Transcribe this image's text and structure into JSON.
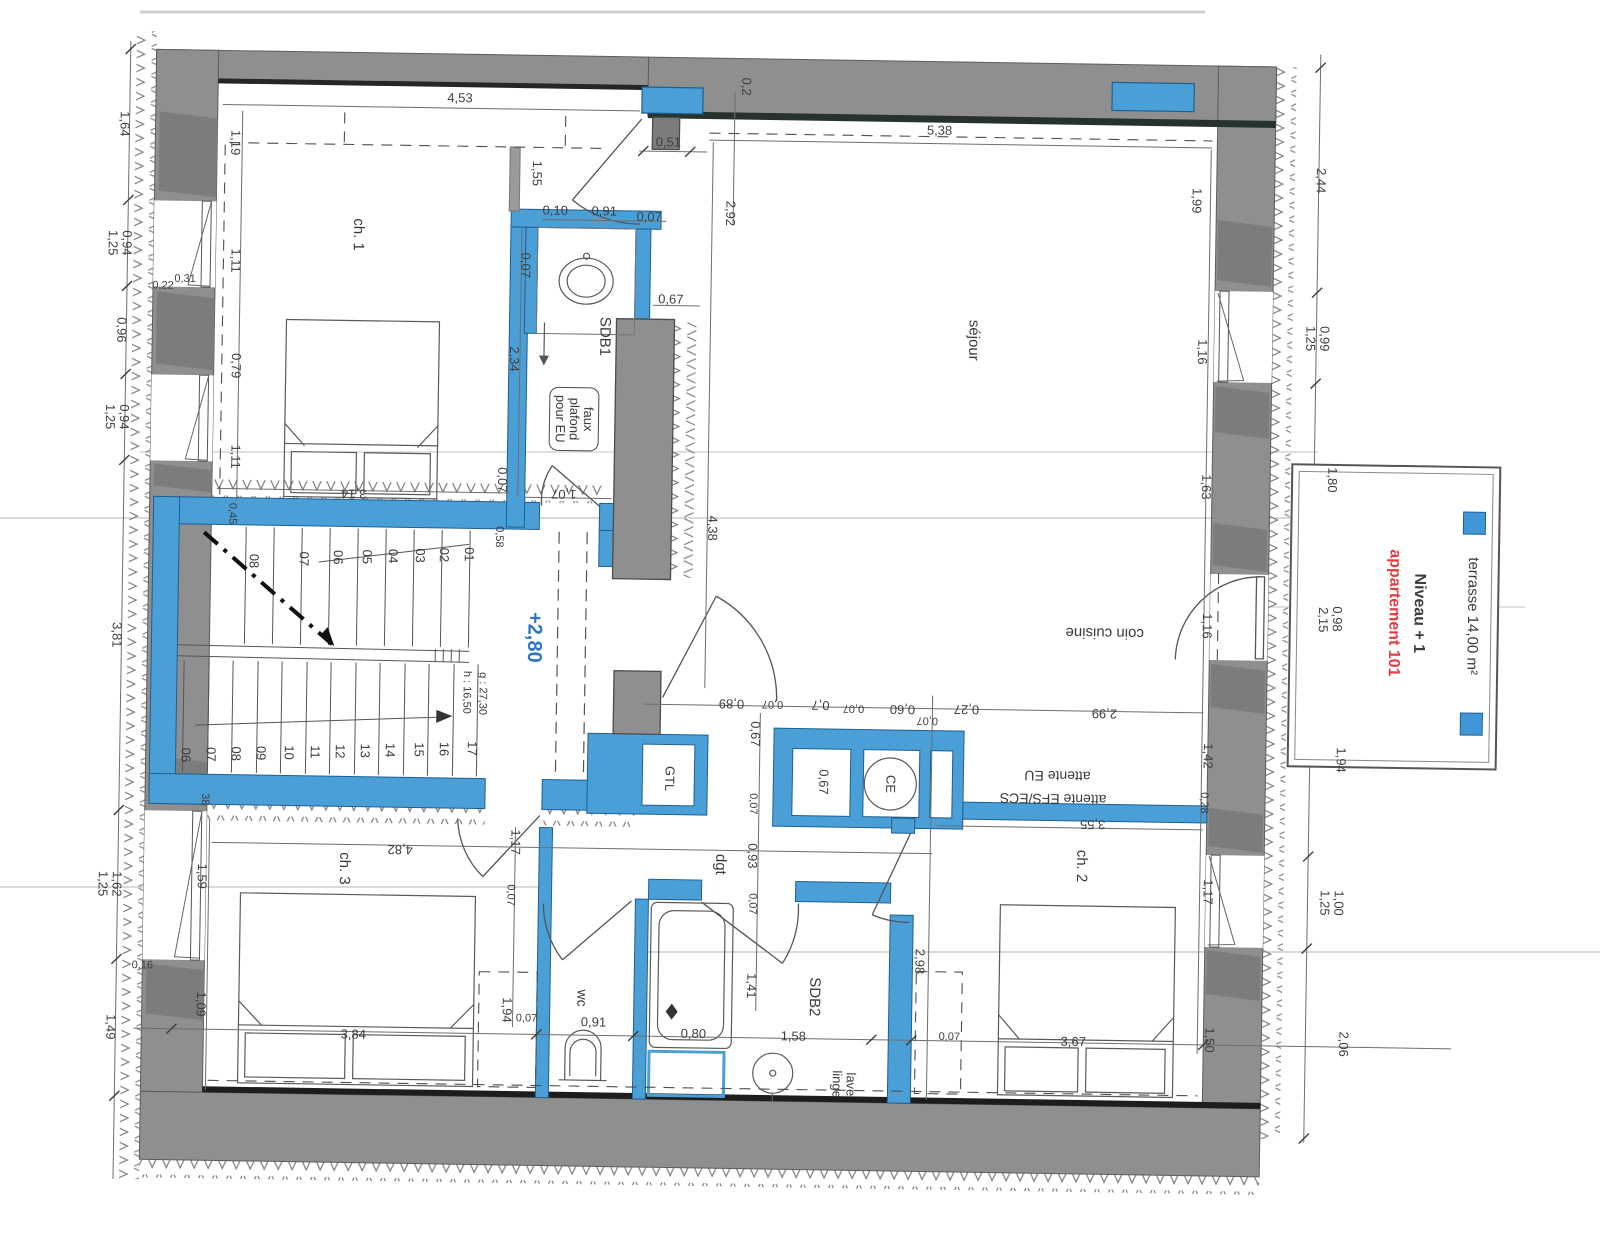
{
  "page": {
    "background": "#ffffff",
    "type": "architectural floor plan scan"
  },
  "colors": {
    "wall_gray": "#8f8f8f",
    "wall_gray_dark": "#7c7c7c",
    "partition_blue": "#4b9fd7",
    "partition_blue_dark": "#1e5f93",
    "accent_red": "#e23b40",
    "level_blue": "#2e75c8",
    "line_dark": "#2b2b2b",
    "dim_text": "#3f3f3f"
  },
  "legend": {
    "terrace_label": "terrasse 14,00 m²",
    "level_label": "Niveau + 1",
    "apartment_label": "appartement 101"
  },
  "stairs": {
    "upper_steps": [
      "01",
      "02",
      "03",
      "04",
      "05",
      "06",
      "07",
      "08"
    ],
    "lower_steps": [
      "06",
      "07",
      "08",
      "09",
      "10",
      "11",
      "12",
      "13",
      "14",
      "15",
      "16",
      "17"
    ],
    "riser_label": "h : 16,50",
    "going_label": "g : 27,30",
    "level_label": "+2,80"
  },
  "labels": [
    {
      "id": "room-ch1",
      "t": "ch. 1",
      "x": 352,
      "y": 240,
      "r": 90,
      "s": 15
    },
    {
      "id": "room-sejour",
      "t": "séjour",
      "x": 969,
      "y": 336,
      "r": 90,
      "s": 15
    },
    {
      "id": "room-coin-cuisine",
      "t": "coin cuisine",
      "x": 1105,
      "y": 626,
      "r": 180,
      "s": 15
    },
    {
      "id": "room-sdb1",
      "t": "SDB1",
      "x": 600,
      "y": 338,
      "r": 90,
      "s": 15
    },
    {
      "id": "note-faux-plafond",
      "t": "faux\nplafond\npour EU",
      "x": 571,
      "y": 421,
      "r": 90,
      "s": 13,
      "box": true
    },
    {
      "id": "room-dgt",
      "t": "dgt",
      "x": 724,
      "y": 864,
      "r": 90,
      "s": 15
    },
    {
      "id": "room-wc",
      "t": "wc",
      "x": 588,
      "y": 1000,
      "r": 90,
      "s": 14
    },
    {
      "id": "room-sdb2",
      "t": "SDB2",
      "x": 820,
      "y": 995,
      "r": 90,
      "s": 15
    },
    {
      "id": "room-lave-linge",
      "t": "lave\nlinge",
      "x": 851,
      "y": 1082,
      "r": 90,
      "s": 13
    },
    {
      "id": "room-ch2",
      "t": "ch. 2",
      "x": 1085,
      "y": 860,
      "r": 90,
      "s": 15
    },
    {
      "id": "room-ch3",
      "t": "ch. 3",
      "x": 348,
      "y": 874,
      "r": 90,
      "s": 15
    },
    {
      "id": "tech-gtl",
      "t": "GTL",
      "x": 672,
      "y": 779,
      "r": 90,
      "s": 13
    },
    {
      "id": "tech-ce",
      "t": "CE",
      "x": 893,
      "y": 781,
      "r": 90,
      "s": 13
    },
    {
      "id": "note-attente-eu",
      "t": "attente EU",
      "x": 1060,
      "y": 770,
      "r": 180,
      "s": 14
    },
    {
      "id": "note-attente-efs-ecs",
      "t": "attente EFS/ECS",
      "x": 1056,
      "y": 793,
      "r": 180,
      "s": 14
    },
    {
      "id": "level-280",
      "t": "+2,80",
      "x": 534,
      "y": 640,
      "r": 90,
      "s": 20,
      "c": "#2e75c8",
      "b": true
    },
    {
      "id": "stair-riser",
      "t": "h : 16,50",
      "x": 467,
      "y": 696,
      "r": 90,
      "s": 11
    },
    {
      "id": "stair-going",
      "t": "g : 27,30",
      "x": 483,
      "y": 697,
      "r": 90,
      "s": 11
    },
    {
      "id": "title-niveau",
      "t": "Niveau + 1",
      "x": 1419,
      "y": 602,
      "r": 90,
      "s": 16,
      "b": true,
      "c": "#3c3c3c"
    },
    {
      "id": "title-appartement",
      "t": "appartement 101",
      "x": 1394,
      "y": 602,
      "r": 90,
      "s": 16,
      "b": true,
      "c": "#e23b40"
    },
    {
      "id": "title-terrasse",
      "t": "terrasse 14,00 m²",
      "x": 1472,
      "y": 604,
      "r": 90,
      "s": 15
    },
    {
      "id": "step-u-01",
      "t": "01",
      "x": 468,
      "y": 558,
      "r": 90,
      "s": 13
    },
    {
      "id": "step-u-02",
      "t": "02",
      "x": 443,
      "y": 559,
      "r": 90,
      "s": 13
    },
    {
      "id": "step-u-03",
      "t": "03",
      "x": 419,
      "y": 560,
      "r": 90,
      "s": 13
    },
    {
      "id": "step-u-04",
      "t": "04",
      "x": 392,
      "y": 561,
      "r": 90,
      "s": 13
    },
    {
      "id": "step-u-05",
      "t": "05",
      "x": 366,
      "y": 562,
      "r": 90,
      "s": 13
    },
    {
      "id": "step-u-06",
      "t": "06",
      "x": 337,
      "y": 563,
      "r": 90,
      "s": 13
    },
    {
      "id": "step-u-07",
      "t": "07",
      "x": 303,
      "y": 565,
      "r": 90,
      "s": 13
    },
    {
      "id": "step-u-08",
      "t": "08",
      "x": 253,
      "y": 568,
      "r": 90,
      "s": 13
    },
    {
      "id": "step-l-06",
      "t": "06",
      "x": 188,
      "y": 763,
      "r": 90,
      "s": 13
    },
    {
      "id": "step-l-07",
      "t": "07",
      "x": 213,
      "y": 762,
      "r": 90,
      "s": 13
    },
    {
      "id": "step-l-08",
      "t": "08",
      "x": 238,
      "y": 761,
      "r": 90,
      "s": 13
    },
    {
      "id": "step-l-09",
      "t": "09",
      "x": 263,
      "y": 760,
      "r": 90,
      "s": 13
    },
    {
      "id": "step-l-10",
      "t": "10",
      "x": 291,
      "y": 759,
      "r": 90,
      "s": 13
    },
    {
      "id": "step-l-11",
      "t": "11",
      "x": 317,
      "y": 758,
      "r": 90,
      "s": 13
    },
    {
      "id": "step-l-12",
      "t": "12",
      "x": 342,
      "y": 757,
      "r": 90,
      "s": 13
    },
    {
      "id": "step-l-13",
      "t": "13",
      "x": 367,
      "y": 756,
      "r": 90,
      "s": 13
    },
    {
      "id": "step-l-14",
      "t": "14",
      "x": 392,
      "y": 755,
      "r": 90,
      "s": 13
    },
    {
      "id": "step-l-15",
      "t": "15",
      "x": 421,
      "y": 754,
      "r": 90,
      "s": 13
    },
    {
      "id": "step-l-16",
      "t": "16",
      "x": 446,
      "y": 753,
      "r": 90,
      "s": 13
    },
    {
      "id": "step-l-17",
      "t": "17",
      "x": 474,
      "y": 752,
      "r": 90,
      "s": 13
    }
  ],
  "dims": [
    [
      "4,53",
      452,
      102,
      0
    ],
    [
      "0,51",
      661,
      143,
      0
    ],
    [
      "0,10",
      549,
      213,
      0
    ],
    [
      "0,91",
      598,
      213,
      0
    ],
    [
      "0,07",
      643,
      218,
      0
    ],
    [
      "0,67",
      666,
      300,
      0
    ],
    [
      "0,2",
      738,
      86,
      90
    ],
    [
      "5,38",
      932,
      127,
      0
    ],
    [
      "2,92",
      724,
      213,
      90
    ],
    [
      "1,55",
      530,
      176,
      90
    ],
    [
      "1,19",
      228,
      150,
      90
    ],
    [
      "1,11",
      230,
      268,
      90
    ],
    [
      "0,22",
      158,
      295,
      0,
      11
    ],
    [
      "0,31",
      180,
      288,
      0,
      11
    ],
    [
      "0,79",
      232,
      373,
      90
    ],
    [
      "1,11",
      233,
      464,
      90
    ],
    [
      "0,45",
      230,
      521,
      90,
      11
    ],
    [
      "0,07",
      520,
      268,
      90
    ],
    [
      "2,34",
      510,
      362,
      90
    ],
    [
      "0,07",
      500,
      483,
      90
    ],
    [
      "1,07",
      562,
      496,
      180
    ],
    [
      "0,58",
      497,
      540,
      90,
      11
    ],
    [
      "3,14",
      352,
      499,
      180
    ],
    [
      "4,38",
      711,
      528,
      90
    ],
    [
      "1,99",
      1190,
      193,
      90
    ],
    [
      "1,16",
      1198,
      344,
      90
    ],
    [
      "1,63",
      1204,
      479,
      90
    ],
    [
      "1,16",
      1207,
      618,
      90
    ],
    [
      "1,42",
      1210,
      748,
      90
    ],
    [
      "0,28",
      1206,
      795,
      90,
      11
    ],
    [
      "1,17",
      1212,
      884,
      90
    ],
    [
      "1,50",
      1216,
      1032,
      90
    ],
    [
      "3,55",
      1096,
      818,
      180
    ],
    [
      "2,44",
      1314,
      171,
      90
    ],
    [
      "0,99",
      1320,
      329,
      90
    ],
    [
      "1,25",
      1306,
      329,
      90
    ],
    [
      "1,80",
      1330,
      470,
      90
    ],
    [
      "0,98",
      1337,
      609,
      90
    ],
    [
      "2,15",
      1323,
      610,
      90
    ],
    [
      "1,94",
      1343,
      750,
      90
    ],
    [
      "1,00",
      1343,
      893,
      90
    ],
    [
      "1,25",
      1329,
      893,
      90
    ],
    [
      "2,06",
      1350,
      1034,
      90
    ],
    [
      "1,64",
      117,
      133,
      90
    ],
    [
      "0,94",
      121,
      252,
      90
    ],
    [
      "1,25",
      107,
      252,
      90
    ],
    [
      "0,96",
      117,
      339,
      90
    ],
    [
      "0,94",
      121,
      426,
      90
    ],
    [
      "1,25",
      107,
      426,
      90
    ],
    [
      "3,81",
      117,
      644,
      90
    ],
    [
      "1,62",
      121,
      893,
      90
    ],
    [
      "1,25",
      107,
      893,
      90
    ],
    [
      "0,16",
      148,
      975,
      0,
      11
    ],
    [
      "1,49",
      117,
      1036,
      90
    ],
    [
      "0,89",
      733,
      703,
      180
    ],
    [
      "0,07",
      774,
      702,
      180,
      11
    ],
    [
      "0,7",
      822,
      703,
      180
    ],
    [
      "0,07",
      855,
      705,
      180,
      11
    ],
    [
      "0,60",
      904,
      706,
      180
    ],
    [
      "0,07",
      929,
      716,
      180,
      11
    ],
    [
      "0,27",
      968,
      705,
      180
    ],
    [
      "2,99",
      1106,
      707,
      180
    ],
    [
      "0,67",
      757,
      733,
      90
    ],
    [
      "0,67",
      826,
      780,
      90
    ],
    [
      "0,07",
      755,
      803,
      90,
      11
    ],
    [
      "0,93",
      756,
      855,
      90
    ],
    [
      "0,07",
      756,
      903,
      90,
      11
    ],
    [
      "1,41",
      757,
      985,
      90
    ],
    [
      "2,98",
      925,
      958,
      90
    ],
    [
      "38",
      207,
      807,
      90,
      11
    ],
    [
      "1,59",
      206,
      884,
      90
    ],
    [
      "1,09",
      207,
      1012,
      90
    ],
    [
      "4,82",
      404,
      854,
      180
    ],
    [
      "1,17",
      519,
      845,
      90
    ],
    [
      "0,07",
      514,
      898,
      90,
      11
    ],
    [
      "1,94",
      513,
      1013,
      90
    ],
    [
      "0,07",
      533,
      1022,
      0,
      11
    ],
    [
      "0,91",
      600,
      1024,
      0
    ],
    [
      "3,84",
      360,
      1040,
      0
    ],
    [
      "0,80",
      700,
      1034,
      0
    ],
    [
      "1,58",
      800,
      1035,
      0
    ],
    [
      "0,07",
      956,
      1034,
      0,
      11
    ],
    [
      "3,67",
      1080,
      1036,
      0
    ]
  ]
}
